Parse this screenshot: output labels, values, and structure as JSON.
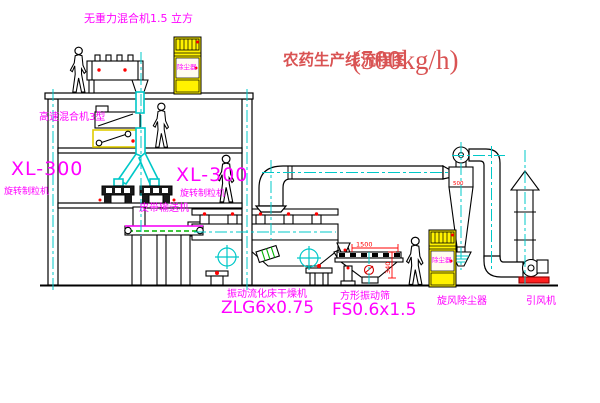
{
  "title": {
    "name": "农药生产线流程图",
    "capacity": "(500kg/h)"
  },
  "equipment": {
    "zero_gravity_mixer": "无重力混合机1.5 立方",
    "high_speed_mixer": "高速混合机3型",
    "granulator_model_left": "XL-300",
    "granulator_name_left": "旋转制粒机",
    "granulator_model_mid": "XL-300",
    "granulator_name_mid": "旋转制粒机",
    "belt_conveyor": "皮带输送机",
    "fluid_bed_dryer": "振动流化床干燥机",
    "fluid_bed_dryer_model": "ZLG6x0.75",
    "square_screen": "方形振动筛",
    "square_screen_model": "FS0.6x1.5",
    "cyclone": "旋风除尘器",
    "fan": "引风机",
    "dust_cabinet_top": "除尘器",
    "dust_cabinet_bottom": "除尘器"
  },
  "dimensions": {
    "screen_width": "1500",
    "screen_height": "340",
    "cyclone_note": "500"
  },
  "colors": {
    "line": "#000000",
    "centerline": "#00C8C8",
    "label_magenta": "#FF00FF",
    "title_red": "#D95353",
    "accent_red": "#FF0000",
    "cabinet_yellow": "#FFF200",
    "belt_green": "#00B400"
  }
}
